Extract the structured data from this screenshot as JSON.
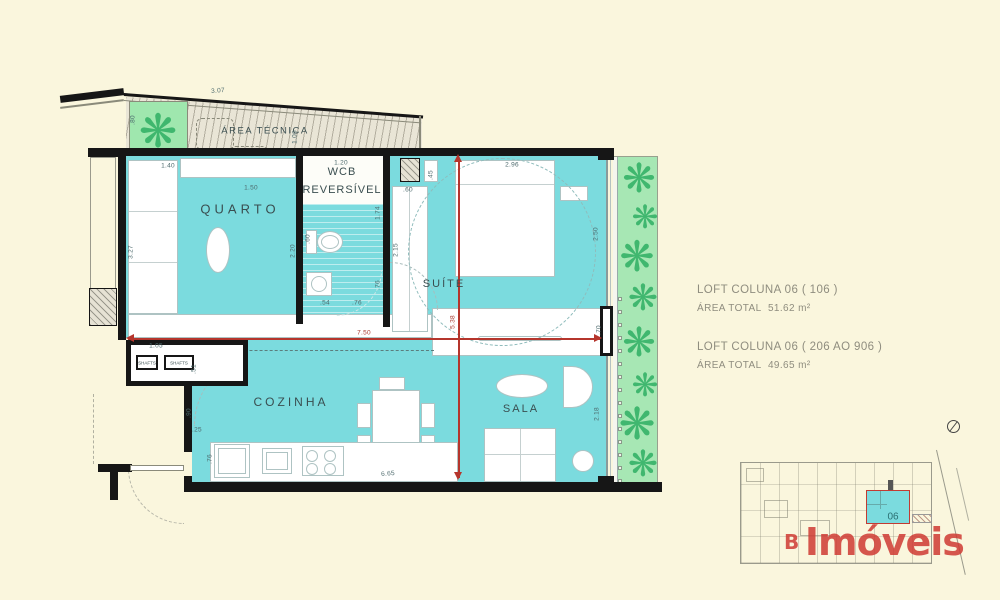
{
  "colors": {
    "teal": "#7BDBDE",
    "garden_green": "#A7E7B4",
    "red_dimension": "#B5352C",
    "logo_red": "#CE3A32",
    "background": "#FAF6DD"
  },
  "plan": {
    "rooms": {
      "quarto": "QUARTO",
      "wcb_line1": "WCB",
      "wcb_line2": "REVERSÍVEL",
      "suite": "SUÍTE",
      "cozinha": "COZINHA",
      "sala": "SALA",
      "area_tecnica": "ÁREA TÉCNICA"
    },
    "shaft_label": "SHAFTS",
    "plant_glyph": "❋",
    "dims": {
      "a307": "3.07",
      "a80": ".80",
      "a106": "1.06",
      "a140": "1.40",
      "a150": "1.50",
      "a327": "3.27",
      "a220": "2.20",
      "a120": "1.20",
      "a174": "1.74",
      "a60t": ".60",
      "a54": ".54",
      "a76a": ".76",
      "a76b": ".76",
      "a215": "2.15",
      "a45": ".45",
      "a60w": ".60",
      "a296": "2.96",
      "a250": "2.50",
      "a538": "5.38",
      "a70": ".70",
      "a750": "7.50",
      "a105": "1.05",
      "a51": ".51",
      "a90": ".90",
      "a25": ".25",
      "a76c": ".76",
      "a665": "6.65",
      "a218": "2.18"
    }
  },
  "info": {
    "blocks": [
      {
        "title": "LOFT COLUNA 06 ( 106 )",
        "area_label": "ÁREA TOTAL",
        "area_value": "51.62 m²"
      },
      {
        "title": "LOFT COLUNA 06 ( 206 AO 906 )",
        "area_label": "ÁREA TOTAL",
        "area_value": "49.65 m²"
      }
    ]
  },
  "keyplan": {
    "unit": "06"
  },
  "watermark": {
    "prefix": "B",
    "name": "Imóveis"
  }
}
